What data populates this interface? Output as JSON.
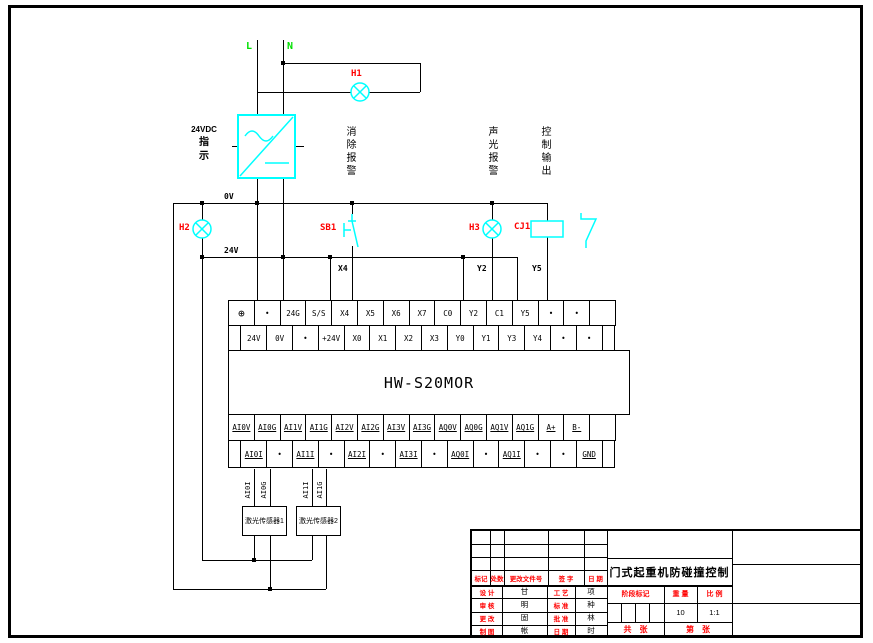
{
  "drawing": {
    "power_labels": {
      "l": "L",
      "n": "N"
    },
    "components": {
      "h1": "H1",
      "h2": "H2",
      "sb1": "SB1",
      "h3": "H3",
      "cj1": "CJ1"
    },
    "psu_note": {
      "line1": "24VDC",
      "line2": "指",
      "line3": "示"
    },
    "function_notes": {
      "note1": "消除报警",
      "note2": "声光报警",
      "note3": "控制输出"
    },
    "wire_labels": {
      "l0v": "0V",
      "l24v": "24V",
      "x4": "X4",
      "y2": "Y2",
      "y5": "Y5"
    },
    "plc": {
      "model": "HW-S20MOR",
      "row_a": [
        "⊕",
        "•",
        "24G",
        "S/S",
        "X4",
        "X5",
        "X6",
        "X7",
        "C0",
        "Y2",
        "C1",
        "Y5",
        "•",
        "•",
        ""
      ],
      "row_b": [
        "24V",
        "0V",
        "•",
        "+24V",
        "X0",
        "X1",
        "X2",
        "X3",
        "Y0",
        "Y1",
        "Y3",
        "Y4",
        "•",
        "•"
      ],
      "row_c": [
        "AI0V",
        "AI0G",
        "AI1V",
        "AI1G",
        "AI2V",
        "AI2G",
        "AI3V",
        "AI3G",
        "AQ0V",
        "AQ0G",
        "AQ1V",
        "AQ1G",
        "A+",
        "B-",
        ""
      ],
      "row_d": [
        "AI0I",
        "•",
        "AI1I",
        "•",
        "AI2I",
        "•",
        "AI3I",
        "•",
        "AQ0I",
        "•",
        "AQ1I",
        "•",
        "•",
        "GND"
      ]
    },
    "sensors": {
      "s1": "激光传感器1",
      "s2": "激光传感器2",
      "pins": [
        "AI0I",
        "AI0G",
        "AI1I",
        "AI1G"
      ]
    }
  },
  "title_block": {
    "drawing_title": "门式起重机防碰撞控制",
    "rev_header": [
      "标记",
      "处数",
      "更改文件号",
      "签 字",
      "日 期"
    ],
    "sign_rows": [
      {
        "label1": "设 计",
        "value1": "甘",
        "label2": "工 艺",
        "value2": "项"
      },
      {
        "label1": "审 核",
        "value1": "明",
        "label2": "标 准",
        "value2": "种"
      },
      {
        "label1": "更 改",
        "value1": "固",
        "label2": "批 准",
        "value2": "林"
      },
      {
        "label1": "制 图",
        "value1": "帐",
        "label2": "日 期",
        "value2": "时"
      }
    ],
    "stage_header": [
      "阶段标记",
      "重 量",
      "比 例"
    ],
    "weight": "10",
    "scale": "1:1",
    "sheet_total": "共　张",
    "sheet_number": "第　张"
  },
  "colors": {
    "wire": "#000000",
    "symbol": "#00ffff",
    "component_label": "#ff0000",
    "phase_label": "#00e000"
  }
}
